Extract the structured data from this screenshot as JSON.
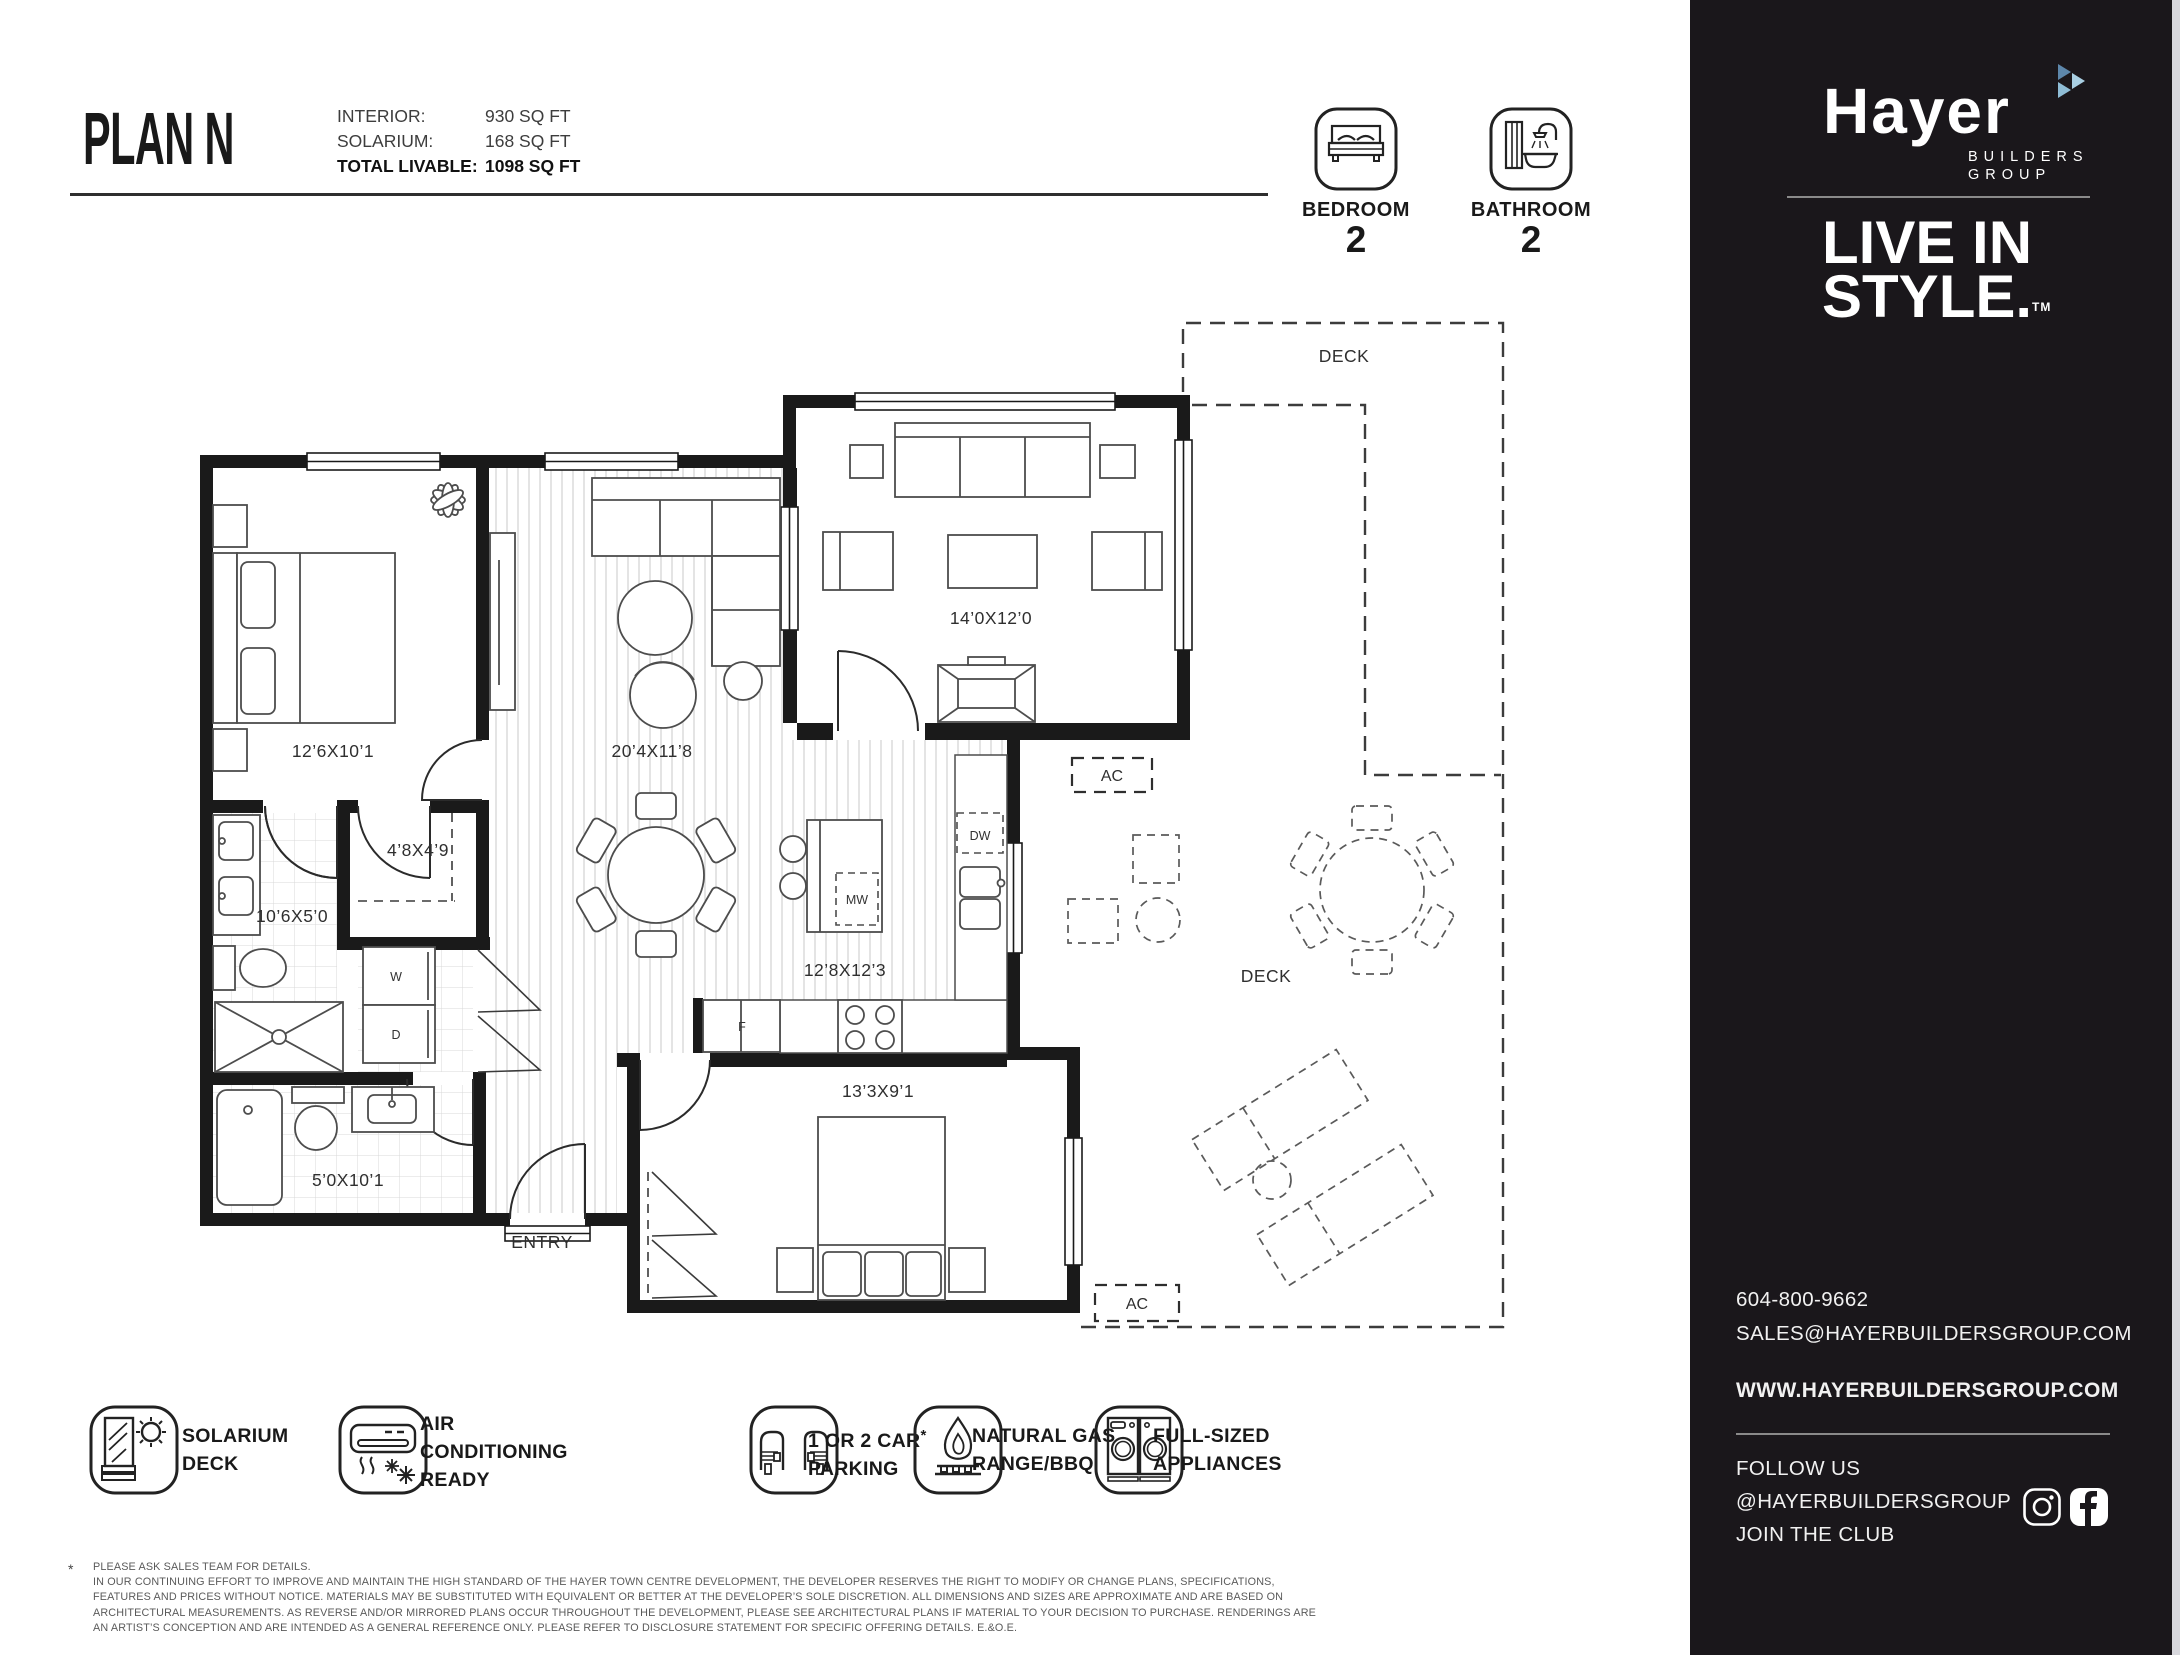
{
  "header": {
    "plan_title": "PLAN N",
    "specs": [
      {
        "label": "INTERIOR:",
        "value": "930 SQ FT"
      },
      {
        "label": "SOLARIUM:",
        "value": "168 SQ FT"
      },
      {
        "label": "TOTAL LIVABLE:",
        "value": "1098 SQ FT"
      }
    ],
    "stats": [
      {
        "label": "BEDROOM",
        "count": "2",
        "icon": "bed-icon"
      },
      {
        "label": "BATHROOM",
        "count": "2",
        "icon": "bathtub-icon"
      }
    ]
  },
  "sidebar": {
    "brand_name": "Hayer",
    "brand_sub1": "BUILDERS",
    "brand_sub2": "GROUP",
    "tagline_line1": "LIVE IN",
    "tagline_line2": "STYLE.",
    "tagline_tm": "TM",
    "phone": "604-800-9662",
    "email": "SALES@HAYERBUILDERSGROUP.COM",
    "website": "WWW.HAYERBUILDERSGROUP.COM",
    "follow_line1": "FOLLOW US",
    "follow_line2": "@HAYERBUILDERSGROUP",
    "follow_line3": "JOIN THE CLUB",
    "social_icons": [
      "instagram-icon",
      "facebook-icon"
    ],
    "colors": {
      "background": "#1a171b",
      "edge_strip": "#d8d8dd",
      "logo_triangle_dark": "#5d87ab",
      "logo_triangle_light": "#a9cfe3",
      "logo_triangle_mid": "#8fbdd6"
    }
  },
  "plan": {
    "rooms": {
      "bedroom1": "12’6X10’1",
      "walkin": "4’8X4’9",
      "ensuite": "10’6X5’0",
      "living": "20’4X11’8",
      "solarium": "14’0X12’0",
      "kitchen": "12’8X12’3",
      "bedroom2": "13’3X9’1",
      "bath2": "5’0X10’1"
    },
    "labels": {
      "entry": "ENTRY",
      "deck_top": "DECK",
      "deck_mid": "DECK",
      "ac_top": "AC",
      "ac_bottom": "AC"
    },
    "appliances": {
      "washer": "W",
      "dryer": "D",
      "fridge": "F",
      "microwave": "MW",
      "dishwasher": "DW"
    }
  },
  "features": [
    {
      "icon": "solarium-deck-icon",
      "lines": [
        "SOLARIUM",
        "DECK"
      ]
    },
    {
      "icon": "air-conditioning-icon",
      "lines": [
        "AIR",
        "CONDITIONING",
        "READY"
      ]
    },
    {
      "icon": "parking-icon",
      "lines": [
        "1 OR 2 CAR",
        "PARKING"
      ],
      "note_marker": "*"
    },
    {
      "icon": "gas-range-icon",
      "lines": [
        "NATURAL GAS",
        "RANGE/BBQ"
      ]
    },
    {
      "icon": "appliances-icon",
      "lines": [
        "FULL-SIZED",
        "APPLIANCES"
      ]
    }
  ],
  "disclaimer": {
    "marker": "*",
    "note": "PLEASE ASK SALES TEAM FOR DETAILS.",
    "lines": [
      "IN OUR CONTINUING EFFORT TO IMPROVE AND MAINTAIN THE HIGH STANDARD OF THE HAYER TOWN CENTRE DEVELOPMENT, THE DEVELOPER RESERVES THE RIGHT TO MODIFY OR CHANGE PLANS, SPECIFICATIONS,",
      "FEATURES AND PRICES WITHOUT NOTICE. MATERIALS MAY BE SUBSTITUTED WITH EQUIVALENT OR BETTER AT THE DEVELOPER’S SOLE DISCRETION. ALL DIMENSIONS AND SIZES ARE APPROXIMATE AND ARE BASED ON",
      "ARCHITECTURAL MEASUREMENTS. AS REVERSE AND/OR MIRRORED PLANS OCCUR THROUGHOUT THE DEVELOPMENT, PLEASE SEE ARCHITECTURAL PLANS IF MATERIAL TO YOUR DECISION TO PURCHASE. RENDERINGS ARE",
      "AN ARTIST’S CONCEPTION AND ARE INTENDED AS A GENERAL REFERENCE ONLY. PLEASE REFER TO DISCLOSURE STATEMENT FOR SPECIFIC OFFERING DETAILS. E.&O.E."
    ]
  }
}
